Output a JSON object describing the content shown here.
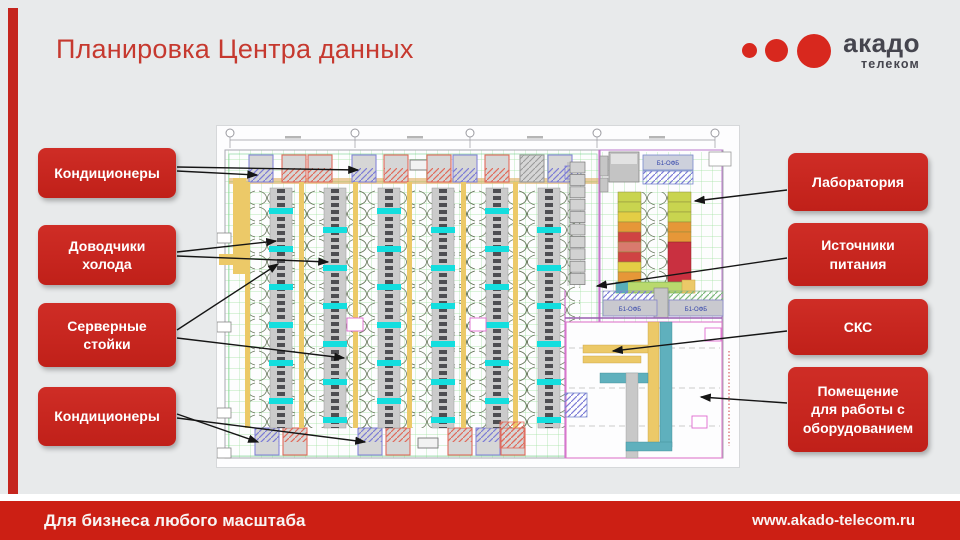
{
  "slide": {
    "title": "Планировка Центра данных",
    "background": "#e8eaeb",
    "accent_red": "#c5251e"
  },
  "logo": {
    "brand": "акадо",
    "sub": "телеком",
    "dot_color": "#d8281e",
    "text_color": "#45454e"
  },
  "footer": {
    "tagline": "Для бизнеса любого масштаба",
    "url": "www.akado-telecom.ru",
    "bar_color": "#cc1f14"
  },
  "plan": {
    "ups_label": "Б1-ОФБ",
    "palette": {
      "grid_green": "#7fd77f",
      "rack_gray": "#cbcbcb",
      "cold_cyan": "#14dede",
      "tray_yellow": "#ecc968",
      "hatch_blue": "#7b7bd6",
      "hatch_red": "#e06a5a",
      "duct_teal": "#5fb0bd",
      "wall_magenta": "#cc77cc"
    }
  },
  "callouts": {
    "left": [
      {
        "id": "conditioners-top",
        "label": "Кондиционеры",
        "arrows": [
          [
            177,
            171,
            257,
            175
          ],
          [
            177,
            167,
            358,
            170
          ]
        ]
      },
      {
        "id": "cold-closers",
        "label": "Доводчики\nхолода",
        "arrows": [
          [
            177,
            252,
            276,
            241
          ],
          [
            177,
            256,
            328,
            262
          ]
        ]
      },
      {
        "id": "server-racks",
        "label": "Серверные\nстойки",
        "arrows": [
          [
            177,
            330,
            278,
            264
          ],
          [
            177,
            338,
            344,
            358
          ]
        ]
      },
      {
        "id": "conditioners-bottom",
        "label": "Кондиционеры",
        "arrows": [
          [
            177,
            414,
            258,
            442
          ],
          [
            177,
            418,
            365,
            442
          ]
        ]
      }
    ],
    "right": [
      {
        "id": "laboratory",
        "label": "Лаборатория",
        "arrows": [
          [
            787,
            190,
            695,
            201
          ]
        ]
      },
      {
        "id": "power-sources",
        "label": "Источники\nпитания",
        "arrows": [
          [
            787,
            258,
            597,
            286
          ]
        ]
      },
      {
        "id": "scs",
        "label": "СКС",
        "arrows": [
          [
            787,
            331,
            613,
            351
          ]
        ]
      },
      {
        "id": "equipment-room",
        "label": "Помещение\nдля работы с\nоборудованием",
        "arrows": [
          [
            787,
            403,
            701,
            397
          ]
        ]
      }
    ]
  }
}
